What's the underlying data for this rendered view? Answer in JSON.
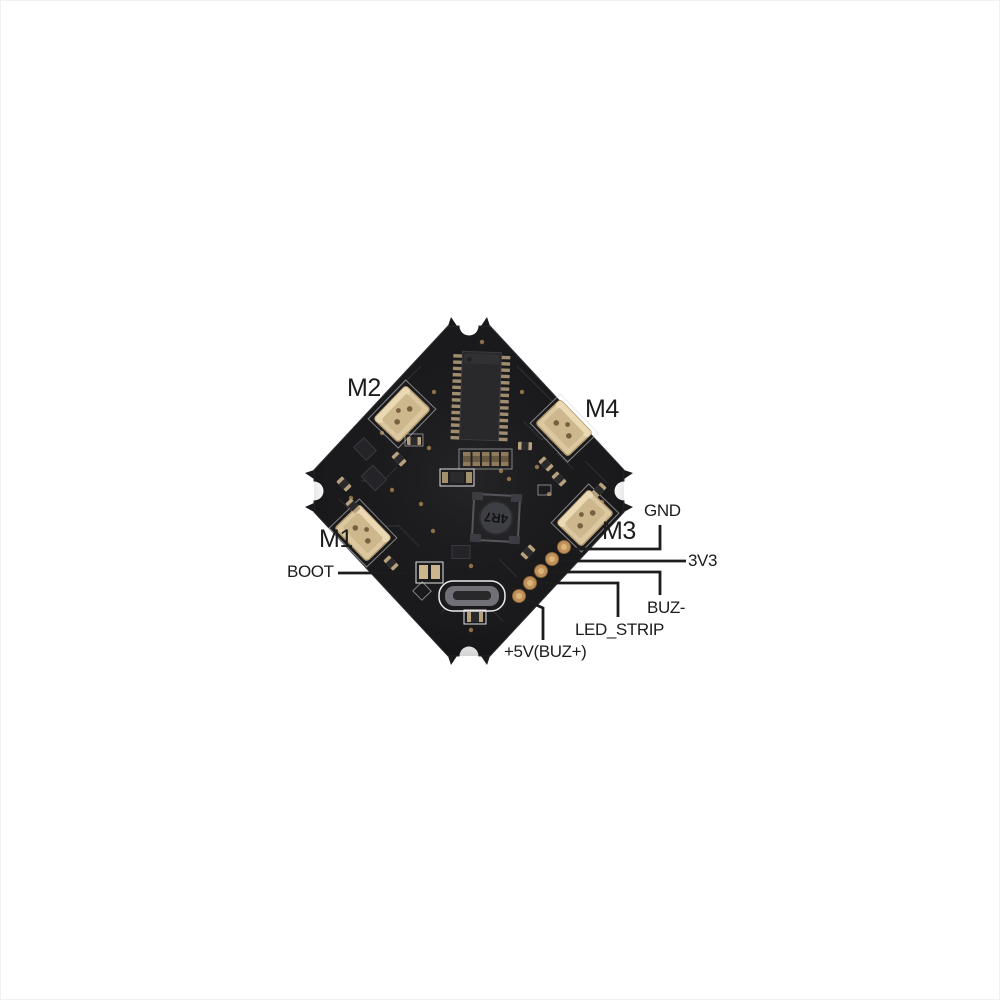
{
  "colors": {
    "background": "#ffffff",
    "board": "#1a1a1c",
    "connector": "#dcc8a0",
    "pad": "#c0915c",
    "annotation": "#1c1c1c"
  },
  "board": {
    "inductor_marking": "4R7",
    "motor_connectors": [
      {
        "id": "m1",
        "label": "M1"
      },
      {
        "id": "m2",
        "label": "M2"
      },
      {
        "id": "m3",
        "label": "M3"
      },
      {
        "id": "m4",
        "label": "M4"
      }
    ],
    "pinout": [
      {
        "id": "boot",
        "label": "BOOT"
      },
      {
        "id": "gnd",
        "label": "GND"
      },
      {
        "id": "3v3",
        "label": "3V3"
      },
      {
        "id": "buz-",
        "label": "BUZ-"
      },
      {
        "id": "led_strip",
        "label": "LED_STRIP"
      },
      {
        "id": "5v_buz+",
        "label": "+5V(BUZ+)"
      }
    ]
  }
}
